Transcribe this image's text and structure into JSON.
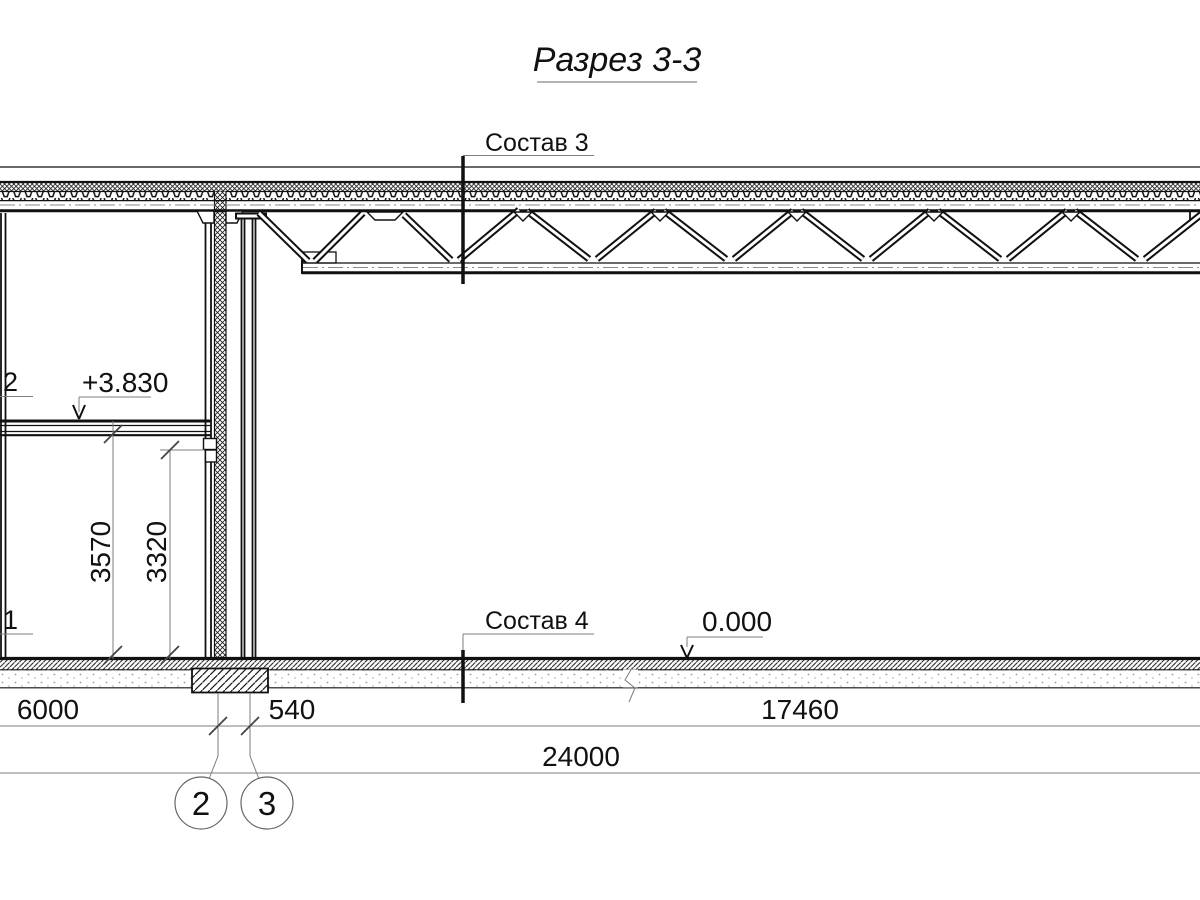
{
  "title": {
    "text": "Разрез 3-3"
  },
  "markers": {
    "sostav3": "Состав 3",
    "sostav4": "Состав 4",
    "cut2": "2",
    "cut1": "1"
  },
  "elevations": {
    "upper": "+3.830",
    "ground": "0.000"
  },
  "dims": {
    "span_left": "6000",
    "wall_offset": "540",
    "span_right": "17460",
    "total": "24000",
    "height_floor": "3570",
    "height_clear": "3320"
  },
  "axes": {
    "a2": "2",
    "a3": "3"
  },
  "colors": {
    "line": "#111111",
    "dim_line": "#7d7d7d",
    "background": "#ffffff"
  }
}
